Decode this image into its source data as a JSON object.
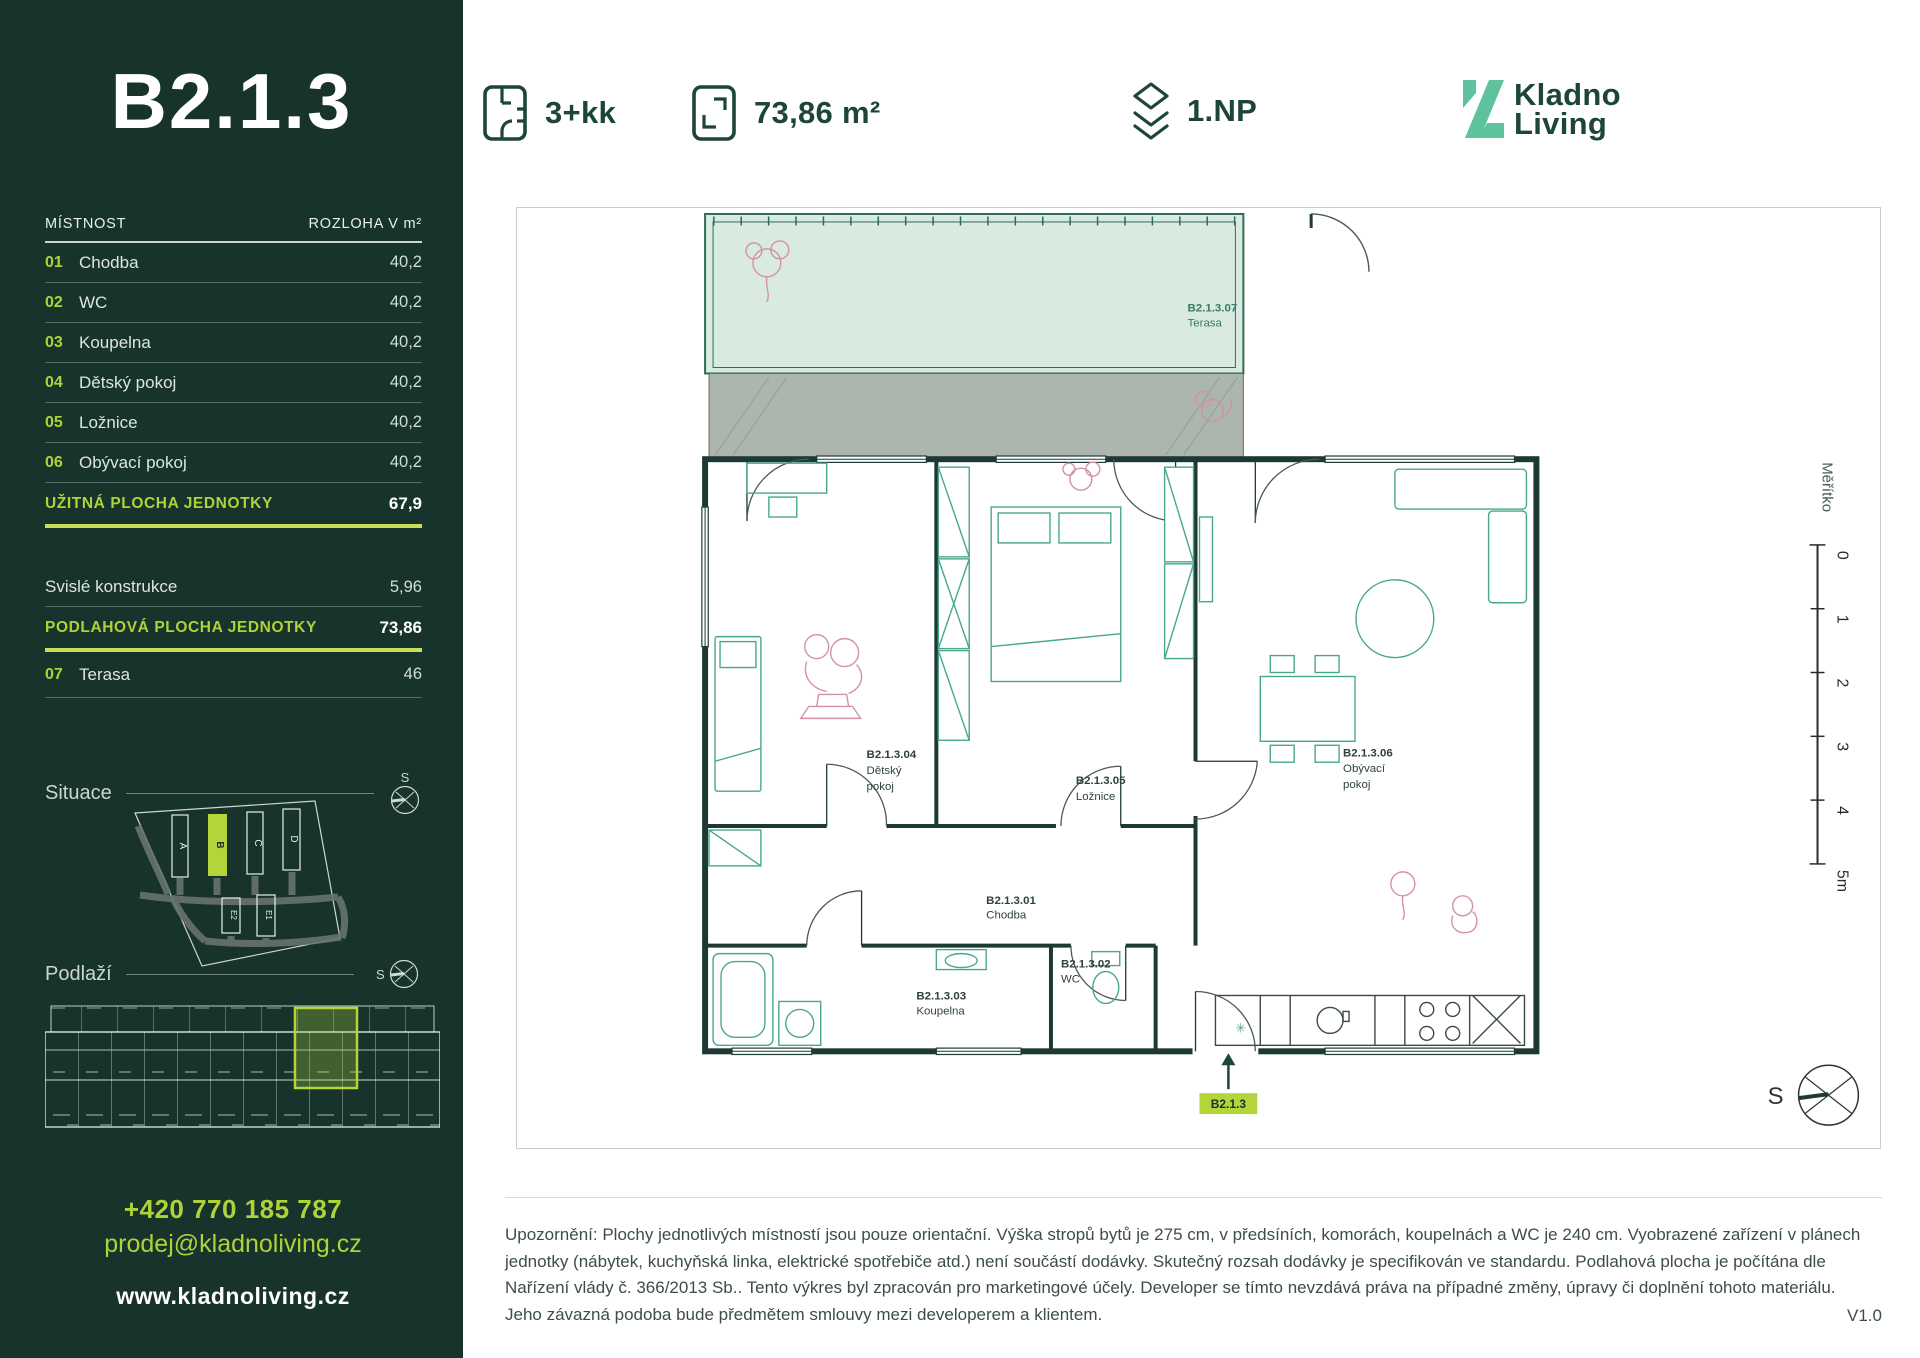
{
  "header": {
    "layout_label": "3+kk",
    "area_label": "73,86 m²",
    "floor_label": "1.NP",
    "brand_line1": "Kladno",
    "brand_line2": "Living"
  },
  "sidebar": {
    "title": "B2.1.3",
    "table": {
      "col_room": "MÍSTNOST",
      "col_area": "ROZLOHA V m²",
      "rows": [
        {
          "num": "01",
          "name": "Chodba",
          "value": "40,2"
        },
        {
          "num": "02",
          "name": "WC",
          "value": "40,2"
        },
        {
          "num": "03",
          "name": "Koupelna",
          "value": "40,2"
        },
        {
          "num": "04",
          "name": "Dětský pokoj",
          "value": "40,2"
        },
        {
          "num": "05",
          "name": "Ložnice",
          "value": "40,2"
        },
        {
          "num": "06",
          "name": "Obývací pokoj",
          "value": "40,2"
        }
      ],
      "usable": {
        "label": "UŽITNÁ PLOCHA JEDNOTKY",
        "value": "67,9"
      },
      "vertical": {
        "label": "Svislé konstrukce",
        "value": "5,96"
      },
      "floor_area": {
        "label": "PODLAHOVÁ PLOCHA JEDNOTKY",
        "value": "73,86"
      },
      "terrace": {
        "num": "07",
        "name": "Terasa",
        "value": "46"
      }
    },
    "situace_label": "Situace",
    "podlazi_label": "Podlaží",
    "compass_letter": "S",
    "site_buildings": [
      "A",
      "B",
      "C",
      "D",
      "E2",
      "E1"
    ],
    "contact": {
      "phone": "+420 770 185 787",
      "email": "prodej@kladnoliving.cz",
      "web": "www.kladnoliving.cz"
    }
  },
  "plan": {
    "rooms": {
      "r01": {
        "code": "B2.1.3.01",
        "name": "Chodba"
      },
      "r02": {
        "code": "B2.1.3.02",
        "name": "WC"
      },
      "r03": {
        "code": "B2.1.3.03",
        "name": "Koupelna"
      },
      "r04": {
        "code": "B2.1.3.04",
        "name1": "Dětský",
        "name2": "pokoj"
      },
      "r05": {
        "code": "B2.1.3.05",
        "name": "Ložnice"
      },
      "r06": {
        "code": "B2.1.3.06",
        "name1": "Obývací",
        "name2": "pokoj"
      },
      "r07": {
        "code": "B2.1.3.07",
        "name": "Terasa"
      }
    },
    "badge": "B2.1.3",
    "scale_label": "Měřítko",
    "scale_ticks": [
      "0",
      "1",
      "2",
      "3",
      "4",
      "5m"
    ],
    "compass_letter": "S",
    "kitchen_symbol": "✳"
  },
  "footer": {
    "disclaimer_lines": [
      "Upozornění: Plochy jednotlivých místností jsou pouze orientační. Výška stropů bytů je 275 cm, v předsíních, komorách, koupelnách a WC je 240 cm. Vyobrazené zařízení v plánech",
      "jednotky (nábytek, kuchyňská linka, elektrické spotřebiče atd.) není součástí dodávky. Skutečný rozsah dodávky je specifikován ve standardu. Podlahová plocha je počítána dle",
      "Nařízení vlády č. 366/2013 Sb.. Tento výkres byl zpracován pro marketingové účely. Developer se tímto nevzdává práva na případné změny, úpravy či doplnění tohoto materiálu.",
      "Jeho závazná podoba bude předmětem smlouvy mezi developerem a klientem."
    ],
    "version": "V1.0"
  },
  "colors": {
    "sidebar_bg": "#17332B",
    "accent_lime": "#AED339",
    "accent_line": "#C6DF55",
    "dark_green": "#1D453A",
    "brand_mint": "#5EC29D",
    "wall": "#1C3A33",
    "furniture_teal": "#48A78E",
    "terrace_fill": "#D9EAE0",
    "terrace_border": "#2F6B5B",
    "gray_area": "#ACB6AF",
    "sketch_pink": "#D492A1"
  }
}
